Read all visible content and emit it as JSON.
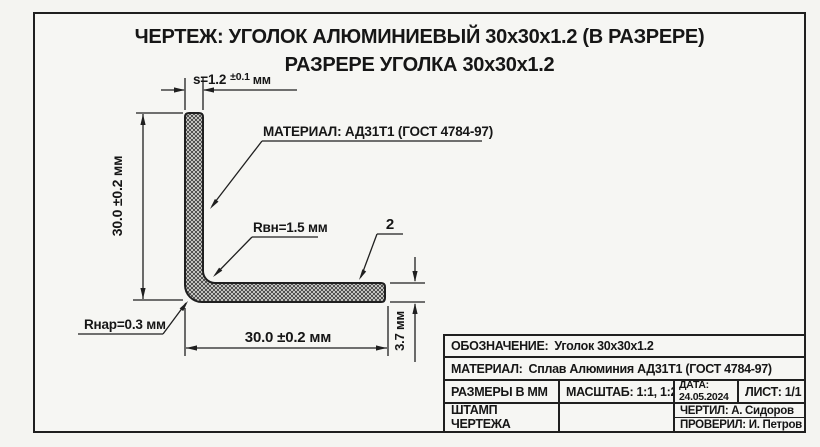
{
  "page": {
    "title_line1": "ЧЕРТЕЖ: УГОЛОК АЛЮМИНИЕВЫЙ 30x30x1.2 (В РАЗРЕРЕ)",
    "title_line2": "РАЗРЕРЕ УГОЛКА 30x30x1.2"
  },
  "drawing": {
    "labels": {
      "thickness_prefix": "s=1.2",
      "thickness_tolerance": "±0.1",
      "thickness_unit": "мм",
      "height_dim": "30.0 ±0.2 мм",
      "width_dim": "30.0 ±0.2 мм",
      "leg_thickness_dim": "3.7 мм",
      "material_callout": "МАТЕРИАЛ: АД31Т1 (ГОСТ 4784-97)",
      "inner_radius": "Rвн=1.5 мм",
      "outer_radius": "Rнар=0.3 мм",
      "position_number": "2"
    }
  },
  "title_block": {
    "designation_label": "ОБОЗНАЧЕНИЕ:",
    "designation_value": "Уголок 30x30x1.2",
    "material_label": "МАТЕРИАЛ:",
    "material_value": "Сплав Алюминия АД31Т1 (ГОСТ 4784-97)",
    "units": "РАЗМЕРЫ В ММ",
    "scale": "МАСШТАБ: 1:1, 1:2",
    "date_label": "ДАТА:",
    "date_value": "24.05.2024",
    "sheet": "ЛИСТ: 1/1",
    "stamp_line1": "ШТАМП",
    "stamp_line2": "ЧЕРТЕЖА",
    "drawn_by": "ЧЕРТИЛ: А. Сидоров",
    "checked_by": "ПРОВЕРИЛ: И. Петров"
  },
  "colors": {
    "paper": "#f6f6f3",
    "line": "#1f1f1f",
    "hatch_line": "#3a3a3a",
    "hatch_bg": "#e4e4df"
  }
}
